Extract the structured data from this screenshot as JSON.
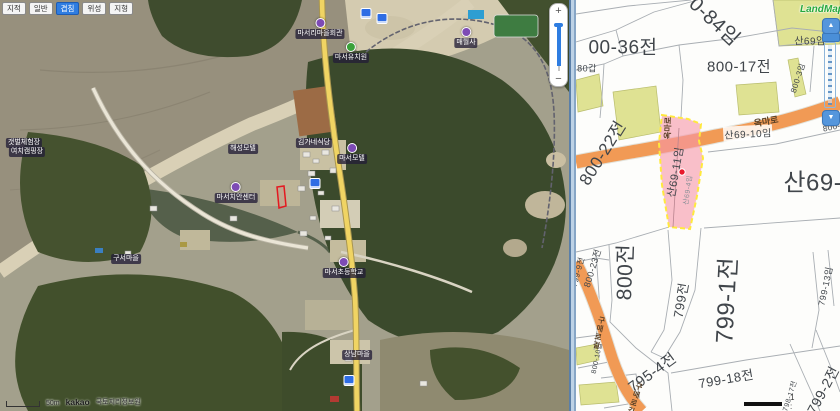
{
  "left_map": {
    "toolbar": [
      {
        "label": "지적",
        "active": false
      },
      {
        "label": "일반",
        "active": false
      },
      {
        "label": "겹침",
        "active": true
      },
      {
        "label": "위성",
        "active": false
      },
      {
        "label": "지형",
        "active": false
      }
    ],
    "zoom": {
      "in": "+",
      "out": "−"
    },
    "logo": "kakao",
    "attribution": "국토지리정보원",
    "scale_label": "50m",
    "selected_outline_color": "#e41920",
    "poi_labels": [
      {
        "type": "bus",
        "x": 366,
        "y": 8
      },
      {
        "type": "bus",
        "x": 382,
        "y": 13
      },
      {
        "type": "poi",
        "color": "#7d4bb5",
        "x": 320,
        "y": 18,
        "text": "마서리마을회관"
      },
      {
        "type": "poi",
        "color": "#3aa13a",
        "x": 351,
        "y": 42,
        "text": "마서유치원"
      },
      {
        "type": "poi",
        "color": "#7d4bb5",
        "x": 466,
        "y": 27,
        "text": "매월사"
      },
      {
        "type": "badge",
        "x": 243,
        "y": 144,
        "text": "해성모텔"
      },
      {
        "type": "badge",
        "x": 314,
        "y": 138,
        "text": "김가네식당"
      },
      {
        "type": "poi",
        "color": "#7d4bb5",
        "x": 352,
        "y": 143,
        "text": "마서모텔"
      },
      {
        "type": "poi",
        "color": "#7d4bb5",
        "x": 236,
        "y": 182,
        "text": "마서치안센터"
      },
      {
        "type": "bus",
        "x": 315,
        "y": 178
      },
      {
        "type": "poi",
        "color": "#7d4bb5",
        "x": 344,
        "y": 257,
        "text": "마서초등학교"
      },
      {
        "type": "badge",
        "x": 126,
        "y": 254,
        "text": "구서마을"
      },
      {
        "type": "badge",
        "x": 357,
        "y": 350,
        "text": "상남마을"
      },
      {
        "type": "bus",
        "x": 349,
        "y": 375
      },
      {
        "type": "badge",
        "x": 24,
        "y": 138,
        "text": "갯벌체험장"
      },
      {
        "type": "badge",
        "x": 27,
        "y": 147,
        "text": "여치캠핑장"
      }
    ]
  },
  "right_map": {
    "logo": "LandMap",
    "scale_text": "1 :",
    "zoom_control": {
      "up": "▲",
      "down": "▼"
    },
    "highlight": {
      "parcel": "산69-11임",
      "sub_parcel": "산69-4임",
      "fill": "#f796a8",
      "border": "#ffe93d",
      "marker_color": "#e8192c"
    },
    "parcel_labels": [
      {
        "text": "0-84임",
        "x": 140,
        "y": 20,
        "size": 20,
        "rot": 43
      },
      {
        "text": "00-36전",
        "x": 47,
        "y": 46,
        "size": 19,
        "rot": 0
      },
      {
        "text": "80갑",
        "x": 11,
        "y": 68,
        "size": 9,
        "rot": 0
      },
      {
        "text": "800-17전",
        "x": 163,
        "y": 66,
        "size": 15,
        "rot": 0
      },
      {
        "text": "산69임",
        "x": 234,
        "y": 40,
        "size": 10,
        "rot": 0
      },
      {
        "text": "800-3임",
        "x": 222,
        "y": 78,
        "size": 8,
        "rot": -72
      },
      {
        "text": "800-7임",
        "x": 262,
        "y": 126,
        "size": 8,
        "rot": -12
      },
      {
        "text": "산69-10임",
        "x": 172,
        "y": 133,
        "size": 10,
        "rot": -3,
        "bg": true
      },
      {
        "text": "산69-13임",
        "x": 262,
        "y": 180,
        "size": 24,
        "rot": 0
      },
      {
        "text": "800-22전",
        "x": 25,
        "y": 152,
        "size": 17,
        "rot": -58
      },
      {
        "text": "산69-11임",
        "x": 99,
        "y": 172,
        "size": 11,
        "rot": -80
      },
      {
        "text": "산69-4임",
        "x": 112,
        "y": 190,
        "size": 7,
        "rot": -82,
        "color": "#8a9097"
      },
      {
        "text": "800전",
        "x": 48,
        "y": 272,
        "size": 21,
        "rot": -88
      },
      {
        "text": "800-23전",
        "x": 16,
        "y": 268,
        "size": 9,
        "rot": -73
      },
      {
        "text": "799-9전",
        "x": 2,
        "y": 272,
        "size": 8,
        "rot": -75
      },
      {
        "text": "800-10답",
        "x": 21,
        "y": 358,
        "size": 7,
        "rot": -78
      },
      {
        "text": "799전",
        "x": 104,
        "y": 300,
        "size": 13,
        "rot": -80
      },
      {
        "text": "799-1전",
        "x": 148,
        "y": 300,
        "size": 24,
        "rot": -87
      },
      {
        "text": "799-18전",
        "x": 150,
        "y": 378,
        "size": 13,
        "rot": -10
      },
      {
        "text": "799-13임",
        "x": 249,
        "y": 286,
        "size": 9,
        "rot": -78
      },
      {
        "text": "799-2전",
        "x": 247,
        "y": 390,
        "size": 14,
        "rot": -62
      },
      {
        "text": "798-17전",
        "x": 214,
        "y": 396,
        "size": 7,
        "rot": -72
      },
      {
        "text": "795-4전",
        "x": 76,
        "y": 372,
        "size": 15,
        "rot": -36
      }
    ],
    "road_labels": [
      {
        "text": "옥마로",
        "x": 92,
        "y": 128,
        "size": 8,
        "rot": -88
      },
      {
        "text": "옥마로",
        "x": 190,
        "y": 121,
        "size": 9,
        "rot": -10
      },
      {
        "text": "구매로길",
        "x": 23,
        "y": 333,
        "size": 7.5,
        "vertical": true,
        "rot": 12
      },
      {
        "text": "구매로길",
        "x": 59,
        "y": 399,
        "size": 7.5,
        "vertical": true,
        "rot": 18
      }
    ]
  },
  "colors": {
    "road_orange": "#f19a55",
    "olive_parcel": "#dfe293",
    "parcel_line": "#a9aeb3",
    "divider": "#87a6c6",
    "highlight_pink": "#f796a8",
    "highlight_border_yellow": "#ffe93d",
    "marker_red": "#e8192c"
  }
}
